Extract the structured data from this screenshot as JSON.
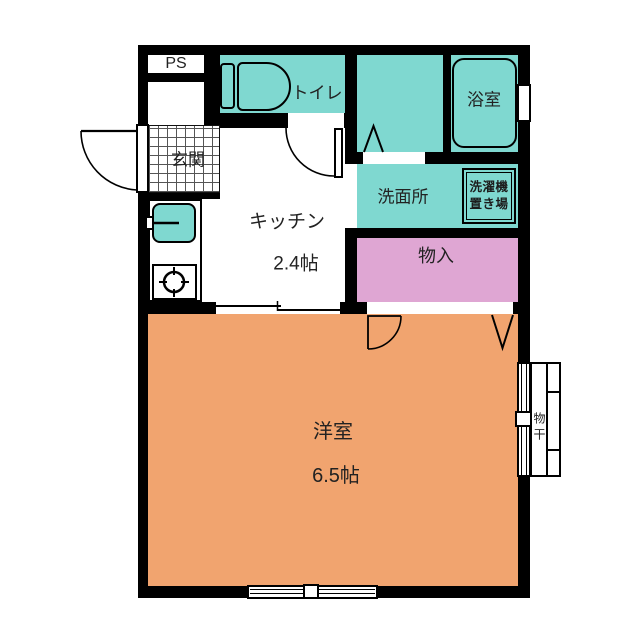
{
  "plan": {
    "rooms": {
      "ps": {
        "label": "PS"
      },
      "toilet": {
        "label": "トイレ"
      },
      "bathroom": {
        "label": "浴室"
      },
      "entrance": {
        "label": "玄関"
      },
      "kitchen": {
        "label": "キッチン",
        "size": "2.4帖"
      },
      "washroom": {
        "label": "洗面所"
      },
      "laundry_space": {
        "line1": "洗濯機",
        "line2": "置き場"
      },
      "closet": {
        "label": "物入"
      },
      "western_room": {
        "label": "洋室",
        "size": "6.5帖"
      },
      "drying_rack": {
        "label": "物干"
      }
    },
    "colors": {
      "wet_area": "#7FD8D0",
      "main_room": "#F1A46F",
      "closet_fill": "#DFA6D3",
      "wall": "#000000"
    }
  }
}
